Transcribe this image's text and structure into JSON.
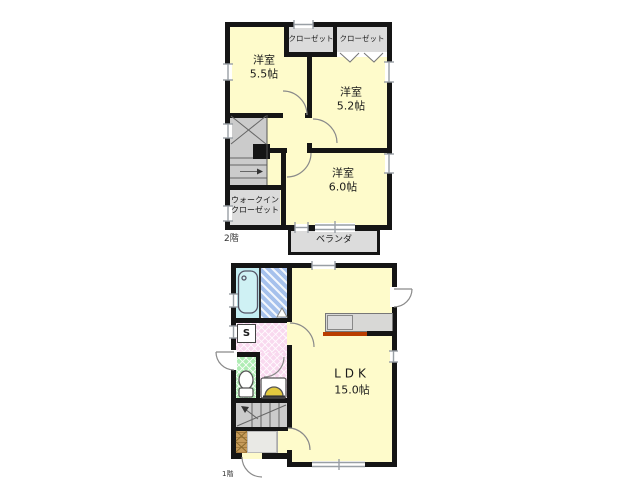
{
  "colors": {
    "room_yellow": "#FEFBCB",
    "bath_cyan": "#C3EDF2",
    "wash_blue": "#A6C1EC",
    "powder_pink": "#F9D9EF",
    "toilet_green": "#AEEDB3",
    "closet_gray": "#DBDBDB",
    "stair_gray": "#CBCBCB",
    "balcony_gray": "#DCDCDC",
    "counter_gray": "#D8D8D6",
    "kitchen_red": "#B93D00",
    "cabinet_tan": "#C69B5A",
    "wall_black": "#151515",
    "line_gray": "#999FA5"
  },
  "floor2": {
    "floor_label": "2階",
    "room_5_5": {
      "title": "洋室",
      "size": "5.5帖"
    },
    "room_5_2": {
      "title": "洋室",
      "size": "5.2帖"
    },
    "room_6_0": {
      "title": "洋室",
      "size": "6.0帖"
    },
    "closet_left": {
      "label": "クローゼット"
    },
    "closet_right": {
      "label": "クローゼット"
    },
    "walkin_closet": {
      "line1": "ウォークイン",
      "line2": "クローゼット"
    },
    "balcony": {
      "label": "ベランダ"
    }
  },
  "floor1": {
    "floor_label": "1階",
    "ldk": {
      "title": "LDK",
      "size": "15.0帖"
    },
    "washer_box": {
      "label": "S"
    }
  }
}
